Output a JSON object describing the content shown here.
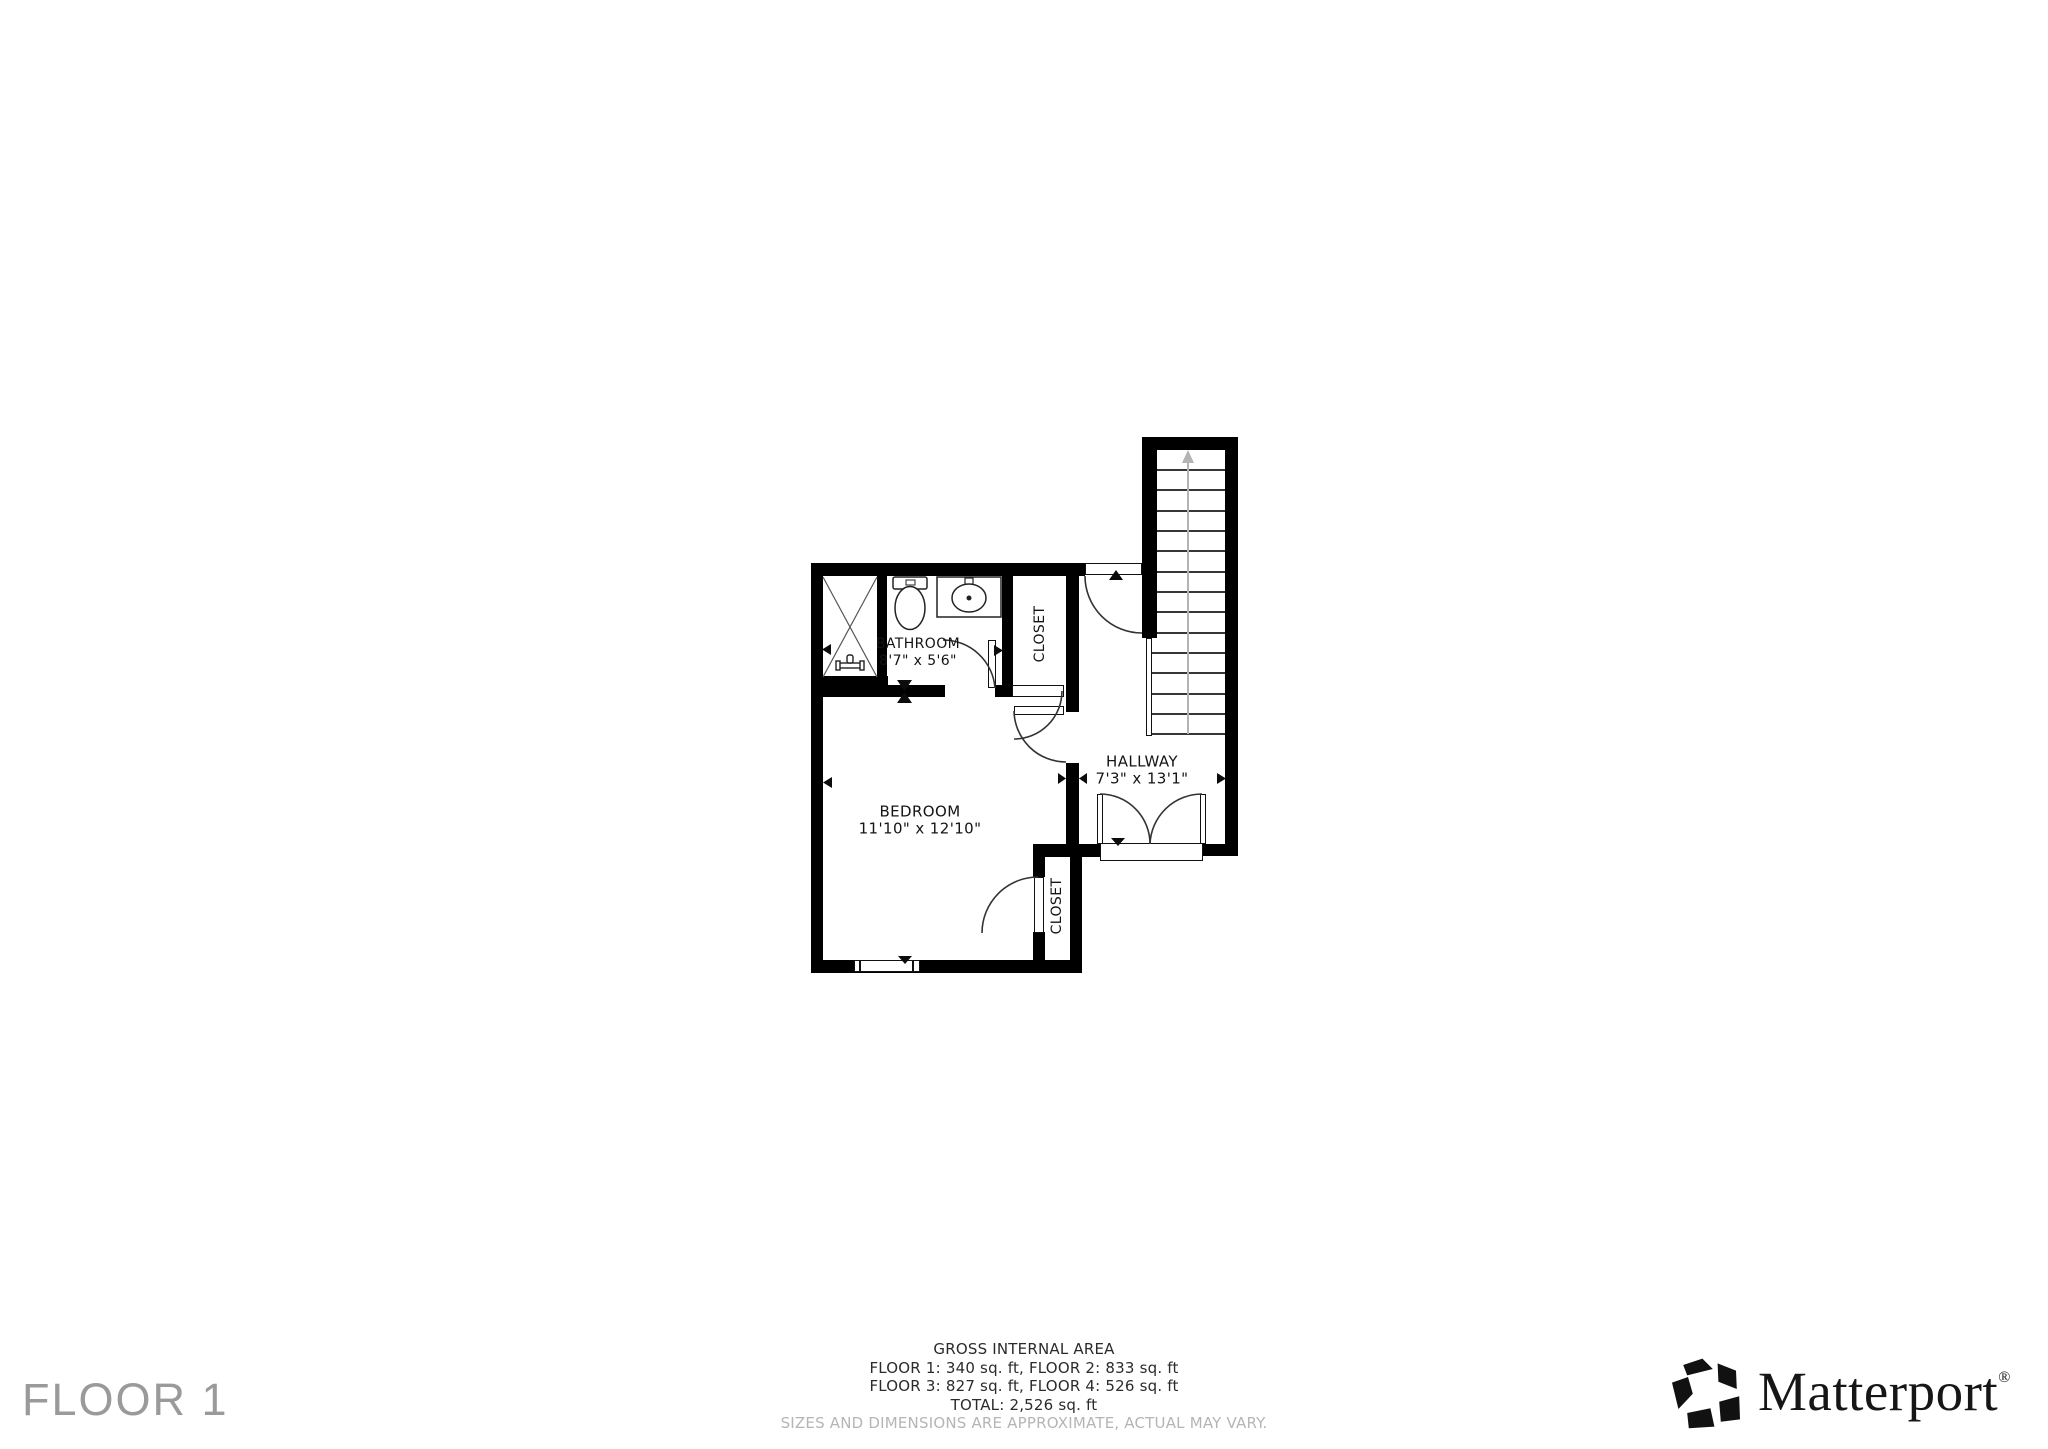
{
  "floor_label": "FLOOR 1",
  "rooms": {
    "bathroom": {
      "name": "BATHROOM",
      "dims": "8'7\" x 5'6\""
    },
    "closet_top": {
      "name": "CLOSET"
    },
    "bedroom": {
      "name": "BEDROOM",
      "dims": "11'10\" x 12'10\""
    },
    "hallway": {
      "name": "HALLWAY",
      "dims": "7'3\" x 13'1\""
    },
    "closet_bottom": {
      "name": "CLOSET"
    }
  },
  "footer": {
    "title": "GROSS INTERNAL AREA",
    "line1": "FLOOR 1: 340 sq. ft, FLOOR 2: 833 sq. ft",
    "line2": "FLOOR 3: 827 sq. ft, FLOOR 4: 526 sq. ft",
    "total": "TOTAL: 2,526 sq. ft",
    "disclaimer": "SIZES AND DIMENSIONS ARE APPROXIMATE, ACTUAL MAY VARY."
  },
  "brand": {
    "name": "Matterport",
    "registered": "®"
  },
  "colors": {
    "wall": "#000000",
    "background": "#ffffff",
    "label": "#141414",
    "floor_title": "#9a9a9a",
    "disclaimer": "#b5b5b5",
    "stair_guide": "#b4b4b4"
  }
}
